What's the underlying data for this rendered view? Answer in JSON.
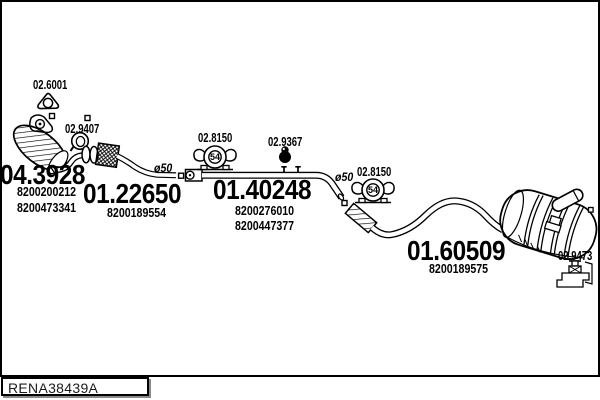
{
  "footer": {
    "code": "RENA38439A"
  },
  "parts": {
    "catalyst": {
      "number": "04.3928",
      "refs": [
        "8200200212",
        "8200473341"
      ]
    },
    "front_pipe": {
      "number": "01.22650",
      "refs": [
        "8200189554"
      ]
    },
    "centre_pipe": {
      "number": "01.40248",
      "refs": [
        "8200276010",
        "8200447377"
      ]
    },
    "rear_muffler": {
      "number": "01.60509",
      "refs": [
        "8200189575"
      ]
    },
    "fittings": [
      "02.6001",
      "02.9407",
      "02.8150",
      "02.9367",
      "02.8150",
      "02.9473"
    ],
    "pipe_diameter": "ø50",
    "hanger_size": "54"
  },
  "labels": [
    {
      "name": "fitting-label-02-6001",
      "text": "02.6001",
      "x": 33,
      "y": 79,
      "cls": "small"
    },
    {
      "name": "fitting-label-02-9407",
      "text": "02.9407",
      "x": 65,
      "y": 123,
      "cls": "small"
    },
    {
      "name": "part-number-04-3928",
      "text": "04.3928",
      "x": 0,
      "y": 161,
      "cls": "big"
    },
    {
      "name": "ref-number-8200200212",
      "text": "8200200212",
      "x": 17,
      "y": 186,
      "cls": "ref"
    },
    {
      "name": "ref-number-8200473341",
      "text": "8200473341",
      "x": 17,
      "y": 202,
      "cls": "ref"
    },
    {
      "name": "part-number-01-22650",
      "text": "01.22650",
      "x": 83,
      "y": 180,
      "cls": "big"
    },
    {
      "name": "ref-number-8200189554",
      "text": "8200189554",
      "x": 107,
      "y": 207,
      "cls": "ref"
    },
    {
      "name": "diameter-label-a",
      "text": "ø50",
      "x": 154,
      "y": 162,
      "cls": "dia"
    },
    {
      "name": "fitting-label-02-8150-a",
      "text": "02.8150",
      "x": 198,
      "y": 132,
      "cls": "small"
    },
    {
      "name": "hanger-size-a",
      "text": "54",
      "x": 207.5,
      "y": 152.5,
      "cls": "fifty4"
    },
    {
      "name": "fitting-label-02-9367",
      "text": "02.9367",
      "x": 268,
      "y": 135.5,
      "cls": "small"
    },
    {
      "name": "part-number-01-40248",
      "text": "01.40248",
      "x": 213,
      "y": 176,
      "cls": "big"
    },
    {
      "name": "ref-number-8200276010",
      "text": "8200276010",
      "x": 235,
      "y": 204.5,
      "cls": "ref"
    },
    {
      "name": "ref-number-8200447377",
      "text": "8200447377",
      "x": 235,
      "y": 220,
      "cls": "ref"
    },
    {
      "name": "diameter-label-b",
      "text": "ø50",
      "x": 335,
      "y": 171,
      "cls": "dia"
    },
    {
      "name": "fitting-label-02-8150-b",
      "text": "02.8150",
      "x": 357,
      "y": 166,
      "cls": "small"
    },
    {
      "name": "hanger-size-b",
      "text": "54",
      "x": 365.5,
      "y": 185.5,
      "cls": "fifty4"
    },
    {
      "name": "part-number-01-60509",
      "text": "01.60509",
      "x": 407,
      "y": 237,
      "cls": "big"
    },
    {
      "name": "ref-number-8200189575",
      "text": "8200189575",
      "x": 429,
      "y": 262.5,
      "cls": "ref"
    },
    {
      "name": "fitting-label-02-9473",
      "text": "02.9473",
      "x": 558,
      "y": 250,
      "cls": "small"
    }
  ]
}
